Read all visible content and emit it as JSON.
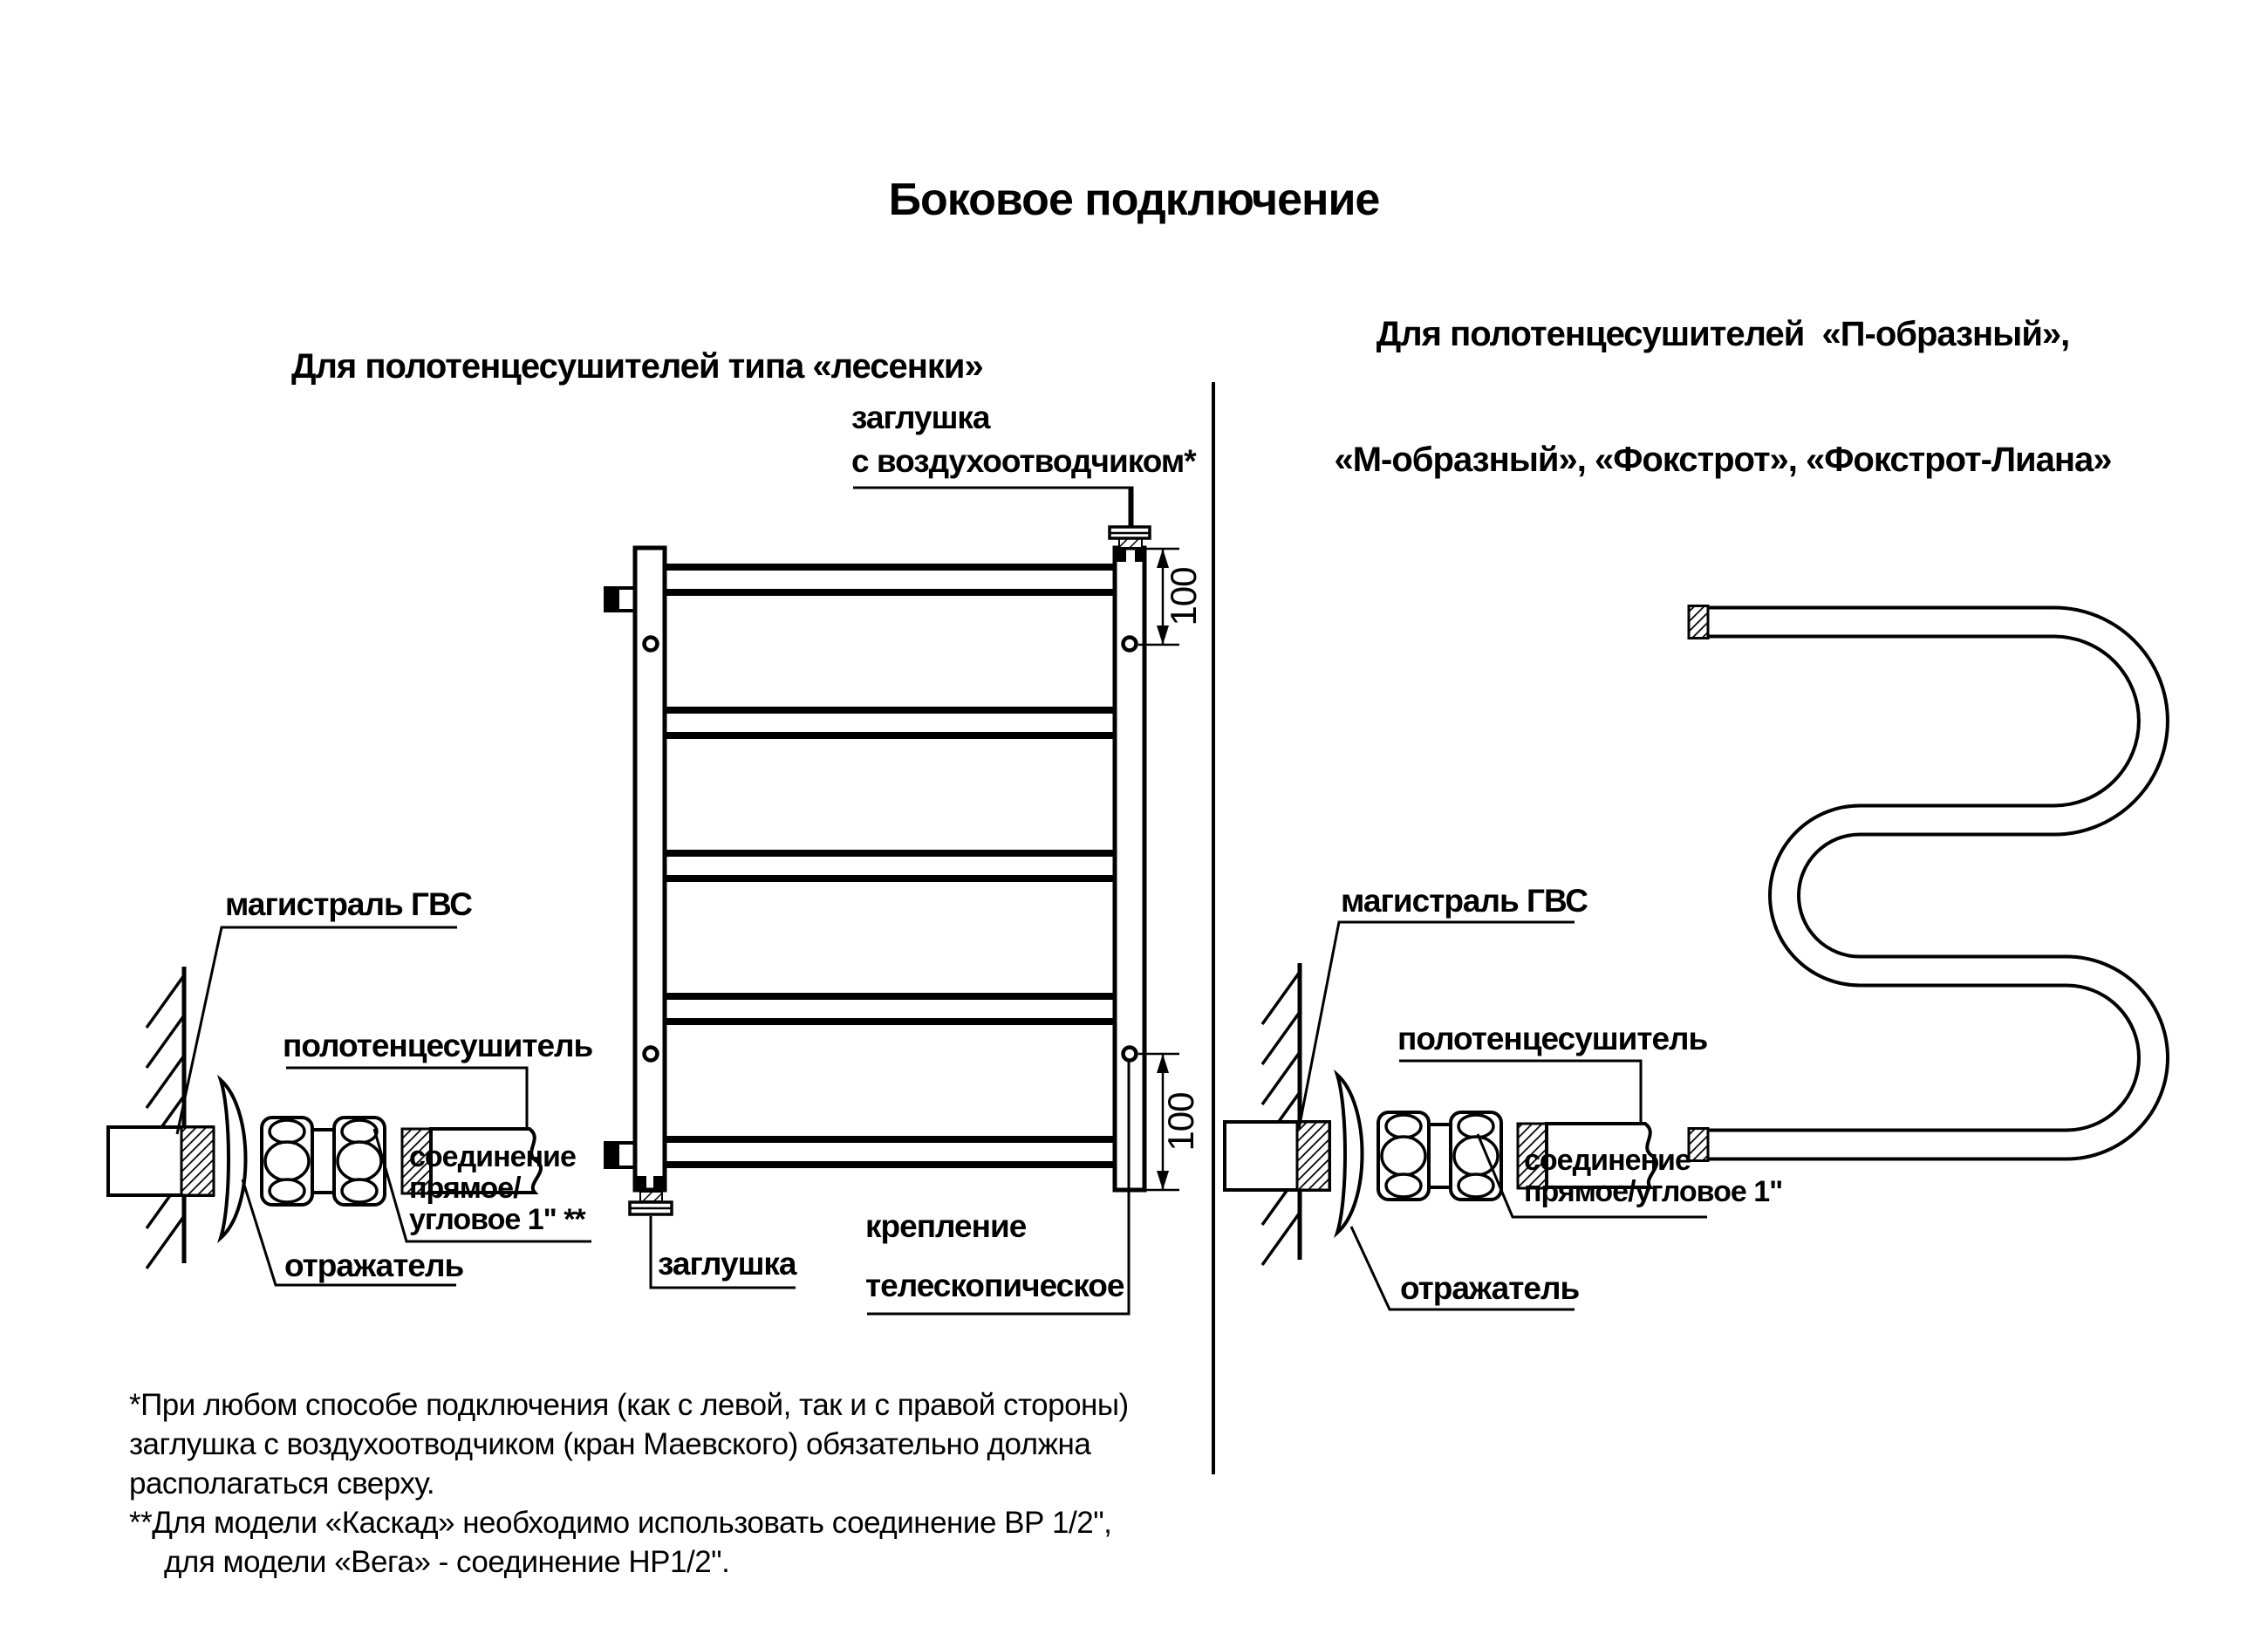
{
  "title": "Боковое подключение",
  "sections": {
    "left": {
      "heading": "Для полотенцесушителей типа «лесенки»"
    },
    "right": {
      "heading_line1": "Для полотенцесушителей  «П-образный»,",
      "heading_line2": "«М-образный», «Фокстрот», «Фокстрот-Лиана»"
    }
  },
  "labels": {
    "air_vent_line1": "заглушка",
    "air_vent_line2": "с воздухоотводчиком*",
    "plug": "заглушка",
    "mount_line1": "крепление",
    "mount_line2": "телескопическое",
    "supply": "магистраль ГВС",
    "towel_rail": "полотенцесушитель",
    "union_left_line1": "соединение",
    "union_left_line2": "прямое/",
    "union_left_line3": "угловое 1\" **",
    "union_right_line1": "соединение",
    "union_right_line2": "прямое/угловое 1\"",
    "reflector": "отражатель",
    "dim_100": "100"
  },
  "footnotes": {
    "line1": "*При любом способе подключения (как с левой, так и с правой стороны)",
    "line2": "заглушка с воздухоотводчиком (кран Маевского) обязательно должна",
    "line3": "располагаться сверху.",
    "line4": "**Для модели «Каскад» необходимо использовать соединение ВР 1/2\",",
    "line5": "для модели «Вега» - соединение НР1/2\"."
  },
  "colors": {
    "ink": "#000000",
    "background": "#ffffff"
  }
}
